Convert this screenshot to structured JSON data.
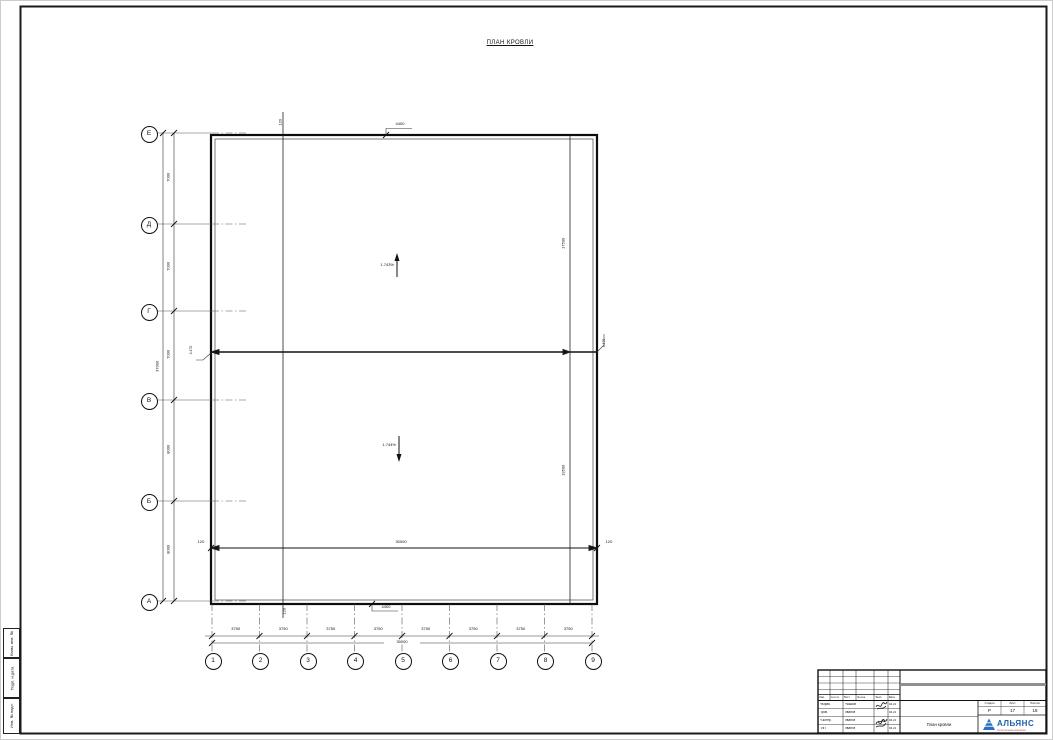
{
  "sheet": {
    "title": "ПЛАН КРОВЛИ"
  },
  "plan": {
    "axes_left": [
      "Е",
      "Д",
      "Г",
      "В",
      "Б",
      "А"
    ],
    "axes_bottom": [
      "1",
      "2",
      "3",
      "4",
      "5",
      "6",
      "7",
      "8",
      "9"
    ],
    "dims_left_chain": [
      "7000",
      "7000",
      "7000",
      "8000",
      "8000"
    ],
    "dim_left_total": "37000",
    "dims_bottom_chain": [
      "3750",
      "3750",
      "3750",
      "3750",
      "3750",
      "3750",
      "3750",
      "3750"
    ],
    "dim_bottom_total": "30000",
    "dim_inner": "30000",
    "offset_top": "120",
    "offset_bottom": "120",
    "offset_inner_left": "120",
    "offset_inner_right": "120",
    "leader_top": "4400",
    "leader_bottom": "4400",
    "slope_upper": "1.743%",
    "slope_lower": "1.744%",
    "dim_right_upper": "17500",
    "dim_right_lower": "19500",
    "mark_left": "4.470",
    "mark_right": "4.470"
  },
  "titleblock": {
    "header_cols": [
      "Изм.",
      "Кол.уч",
      "Лист",
      "№ док.",
      "Подп.",
      "Дата"
    ],
    "rows": [
      {
        "role": "Разраб.",
        "name": "Рыжков",
        "date": "04.21"
      },
      {
        "role": "Пров.",
        "name": "Иванов",
        "date": "04.21"
      },
      {
        "role": "Н.контр.",
        "name": "Иванов",
        "date": "04.21"
      },
      {
        "role": "ГИП",
        "name": "Иванов",
        "date": "04.21"
      }
    ],
    "stage_cols": [
      "Стадия",
      "Лист",
      "Листов"
    ],
    "stage_values": [
      "Р",
      "17",
      "18"
    ],
    "drawing_title": "План кровли",
    "logo_text": "АЛЬЯНС",
    "logo_subtitle": "строительная компания",
    "logo_color": "#1f5fa8"
  },
  "margin_labels": [
    "Взам. инв. №",
    "Подп. и дата",
    "Инв. № подл."
  ]
}
